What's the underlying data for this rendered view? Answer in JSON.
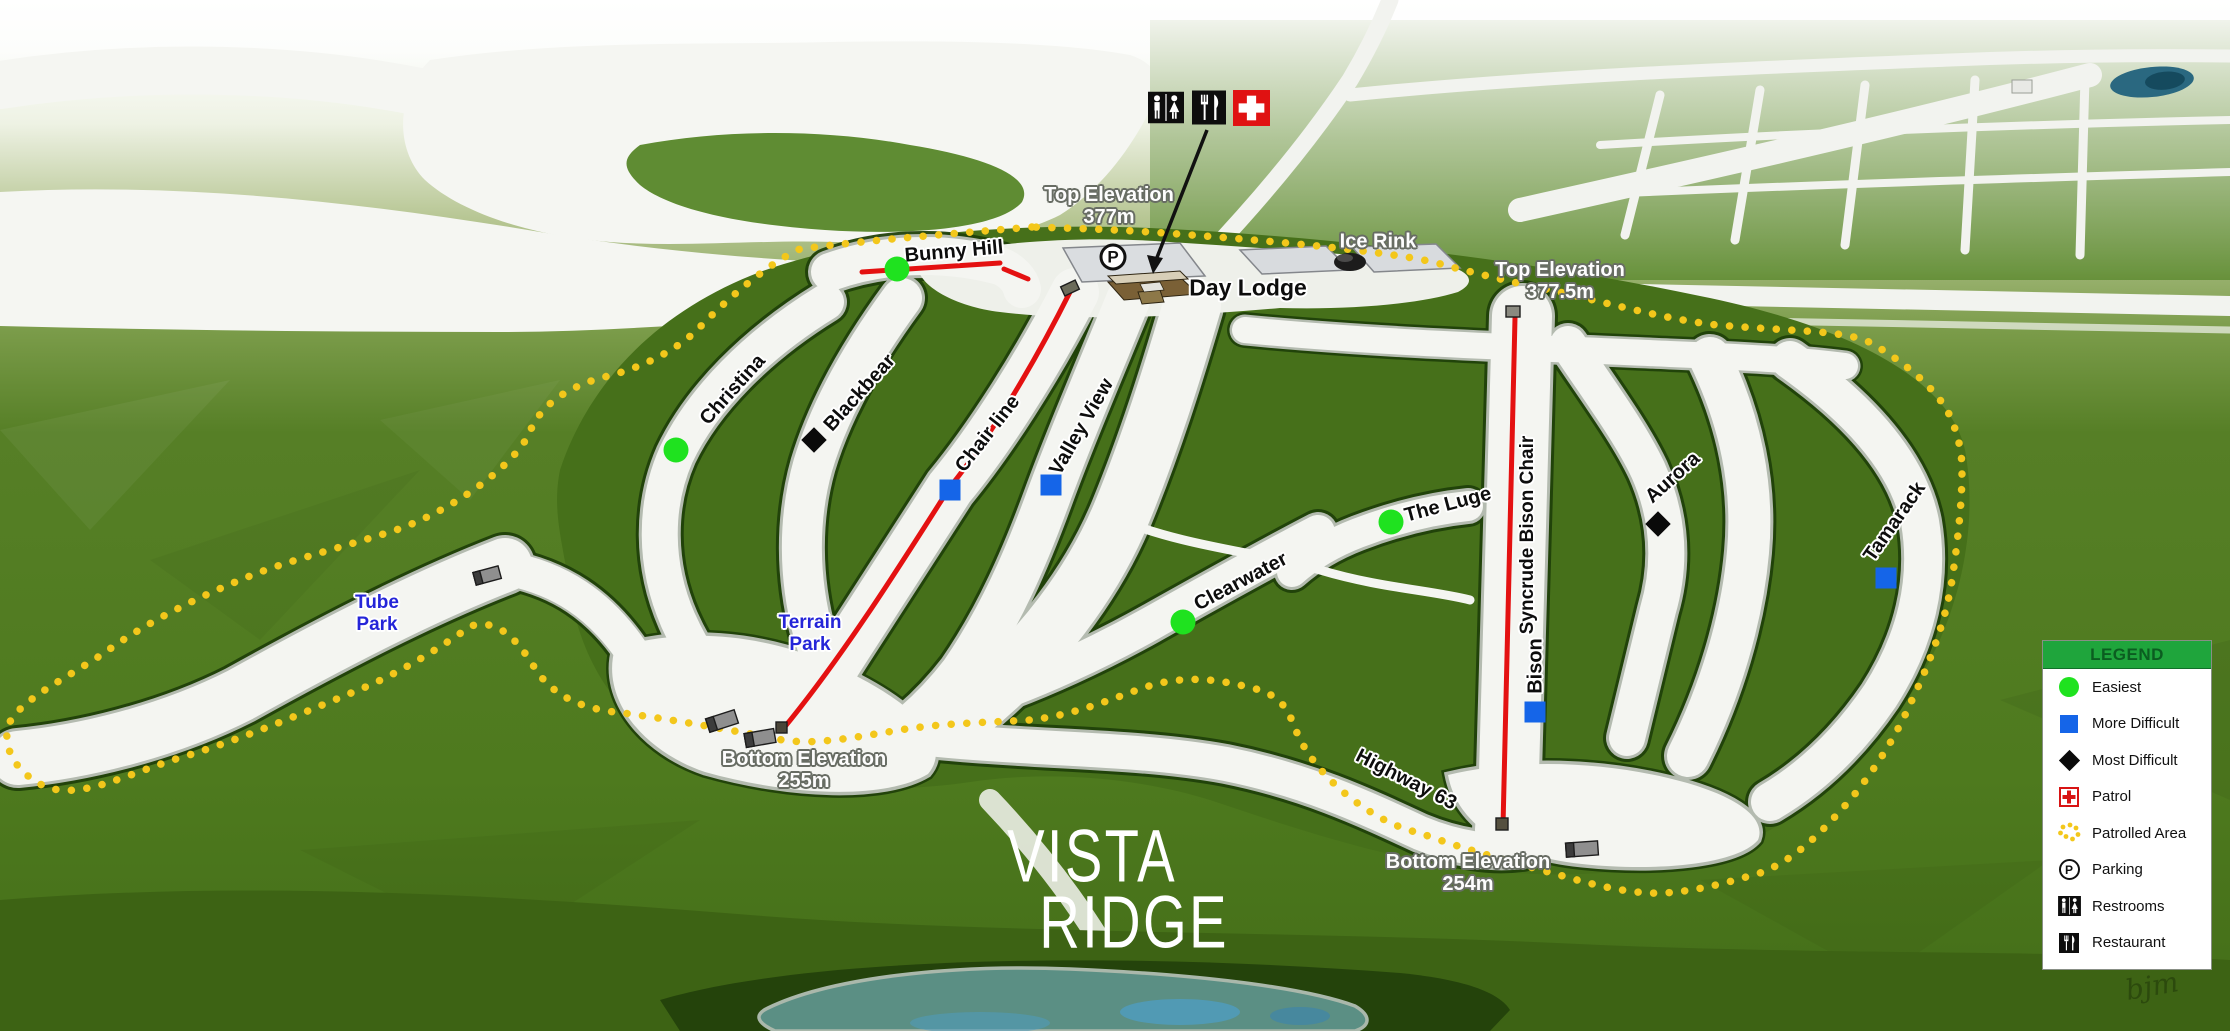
{
  "resort": {
    "logo_line1": "VISTA",
    "logo_line2": "RIDGE",
    "signature": "bjm"
  },
  "facilities": {
    "day_lodge": "Day Lodge",
    "ice_rink": "Ice Rink",
    "parking_symbol": "P"
  },
  "elevations": {
    "top_west": {
      "line1": "Top Elevation",
      "line2": "377m"
    },
    "top_east": {
      "line1": "Top Elevation",
      "line2": "377.5m"
    },
    "bottom_west": {
      "line1": "Bottom Elevation",
      "line2": "255m"
    },
    "bottom_east": {
      "line1": "Bottom Elevation",
      "line2": "254m"
    }
  },
  "trails": [
    {
      "name": "Bunny Hill",
      "difficulty": "easiest"
    },
    {
      "name": "Christina",
      "difficulty": "easiest"
    },
    {
      "name": "Blackbear",
      "difficulty": "most-difficult"
    },
    {
      "name": "Valley View",
      "difficulty": "more-difficult"
    },
    {
      "name": "Clearwater",
      "difficulty": "easiest"
    },
    {
      "name": "The Luge",
      "difficulty": "easiest"
    },
    {
      "name": "Bison",
      "difficulty": "more-difficult"
    },
    {
      "name": "Highway 63",
      "difficulty": "unmarked"
    },
    {
      "name": "Aurora",
      "difficulty": "most-difficult"
    },
    {
      "name": "Tamarack",
      "difficulty": "more-difficult"
    }
  ],
  "lifts": [
    {
      "name": "Chair line"
    },
    {
      "name": "Syncrude Bison Chair"
    }
  ],
  "areas": [
    {
      "line1": "Tube",
      "line2": "Park"
    },
    {
      "line1": "Terrain",
      "line2": "Park"
    }
  ],
  "legend": {
    "title": "LEGEND",
    "items": [
      {
        "label": "Easiest",
        "icon": "easiest-icon"
      },
      {
        "label": "More Difficult",
        "icon": "more-difficult-icon"
      },
      {
        "label": "Most Difficult",
        "icon": "most-difficult-icon"
      },
      {
        "label": "Patrol",
        "icon": "patrol-icon"
      },
      {
        "label": "Patrolled Area",
        "icon": "patrolled-area-icon"
      },
      {
        "label": "Parking",
        "icon": "parking-icon"
      },
      {
        "label": "Restrooms",
        "icon": "restrooms-icon"
      },
      {
        "label": "Restaurant",
        "icon": "restaurant-icon"
      }
    ]
  },
  "colors": {
    "easiest": "#1fe21f",
    "more_difficult": "#1565e8",
    "most_difficult": "#000000",
    "patrol_red": "#e01212",
    "boundary_yellow": "#f3c71b",
    "lift_red": "#e41111",
    "area_label_blue": "#2525d8",
    "legend_green": "#1fa53c"
  }
}
